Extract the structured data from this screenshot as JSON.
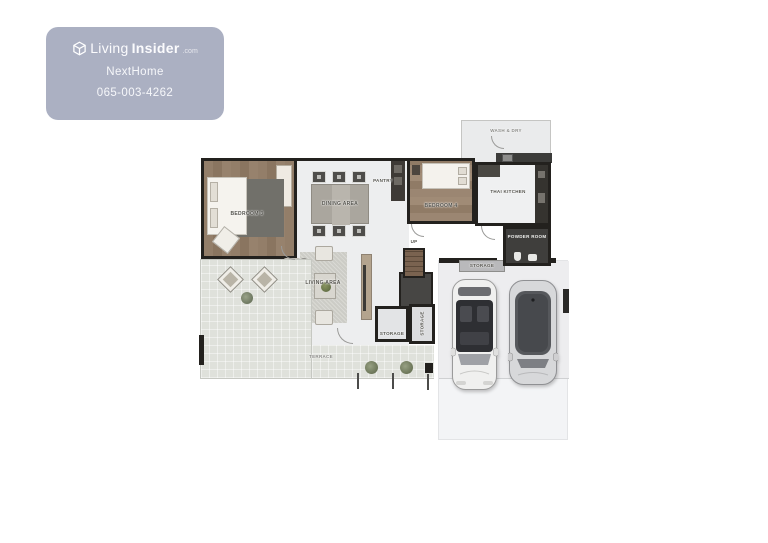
{
  "watermark": {
    "brand": {
      "word1": "Living",
      "word2": "Insider",
      "suffix": ".com"
    },
    "agent_name": "NextHome",
    "phone": "065-003-4262",
    "bg_color": "#a9aec1",
    "logo_icon": "cube-logo-icon"
  },
  "floorplan": {
    "rooms": {
      "wash_dry": "WASH & DRY",
      "bedroom_3": "BEDROOM 3",
      "dining_area": "DINING AREA",
      "pantry": "PANTRY",
      "bedroom_4": "BEDROOM 4",
      "thai_kitchen": "THAI KITCHEN",
      "powder_room": "POWDER ROOM",
      "storage_garage": "STORAGE",
      "stairs_up": "UP",
      "living_area": "LIVING AREA",
      "storage_hall": "STORAGE",
      "storage_side": "STORAGE",
      "terrace": "TERRACE"
    },
    "colors": {
      "wall": "#23211e",
      "interior_floor": "#edeeef",
      "wood_floor": "#8d7762",
      "terrace_tile": "#dfe1db",
      "garage_slab": "#f3f4f6",
      "dark_room": "#3f3e3c"
    },
    "objects": [
      "bed",
      "dining-table",
      "sofa",
      "tv-console",
      "stairs",
      "washing-machine",
      "car",
      "car"
    ]
  }
}
